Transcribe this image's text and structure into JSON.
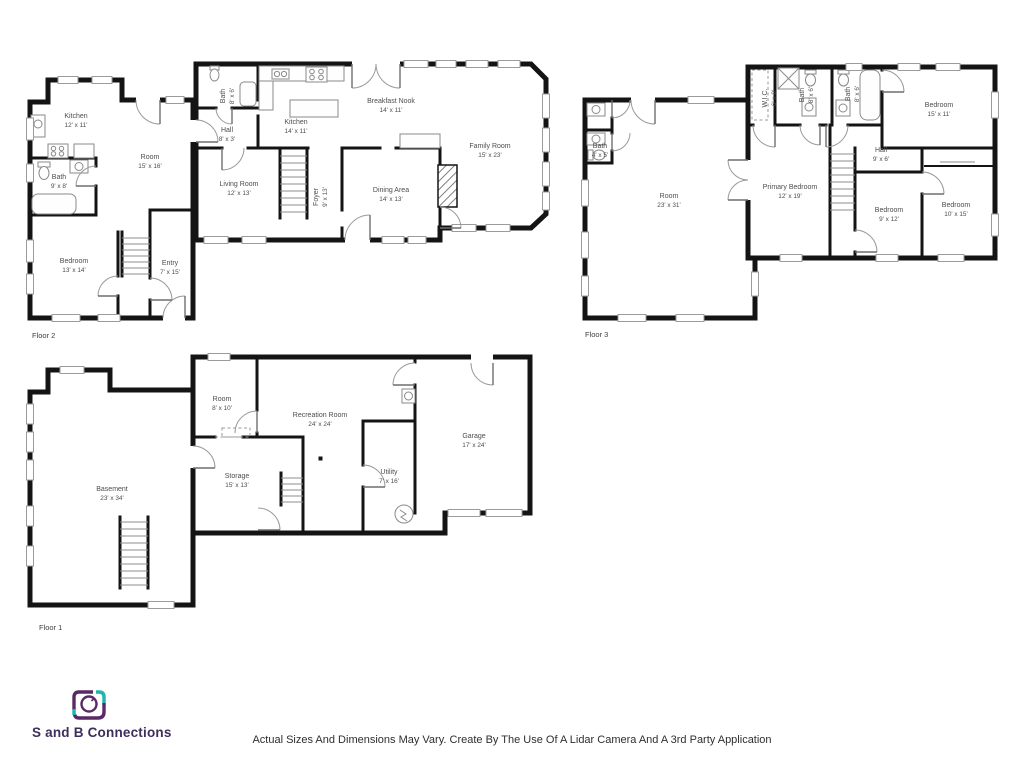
{
  "floors": [
    {
      "label": "Floor 2",
      "rooms": [
        {
          "name": "Kitchen",
          "dims": "12' x 11'"
        },
        {
          "name": "Room",
          "dims": "15' x 16'"
        },
        {
          "name": "Bath",
          "dims": "9' x 8'"
        },
        {
          "name": "Bedroom",
          "dims": "13' x 14'"
        },
        {
          "name": "Entry",
          "dims": "7' x 15'"
        },
        {
          "name": "Bath",
          "dims": "8' x 6'"
        },
        {
          "name": "Hall",
          "dims": "8' x 3'"
        },
        {
          "name": "Kitchen",
          "dims": "14' x 11'"
        },
        {
          "name": "Breakfast Nook",
          "dims": "14' x 11'"
        },
        {
          "name": "Living Room",
          "dims": "12' x 13'"
        },
        {
          "name": "Foyer",
          "dims": "9' x 13'"
        },
        {
          "name": "Dining Area",
          "dims": "14' x 13'"
        },
        {
          "name": "Family Room",
          "dims": "15' x 23'"
        }
      ]
    },
    {
      "label": "Floor 3",
      "rooms": [
        {
          "name": "Bath",
          "dims": "4' x 5'"
        },
        {
          "name": "Room",
          "dims": "23' x 31'"
        },
        {
          "name": "W.I.C.",
          "dims": "6' x 8'"
        },
        {
          "name": "Bath",
          "dims": "8' x 6'"
        },
        {
          "name": "Bath",
          "dims": "8' x 6'"
        },
        {
          "name": "Bedroom",
          "dims": "15' x 11'"
        },
        {
          "name": "Hall",
          "dims": "9' x 6'"
        },
        {
          "name": "Primary Bedroom",
          "dims": "12' x 19'"
        },
        {
          "name": "Bedroom",
          "dims": "9' x 12'"
        },
        {
          "name": "Bedroom",
          "dims": "10' x 15'"
        }
      ]
    },
    {
      "label": "Floor 1",
      "rooms": [
        {
          "name": "Basement",
          "dims": "23' x 34'"
        },
        {
          "name": "Room",
          "dims": "8' x 10'"
        },
        {
          "name": "Recreation Room",
          "dims": "24' x 24'"
        },
        {
          "name": "Storage",
          "dims": "15' x 13'"
        },
        {
          "name": "Utility",
          "dims": "7' x 16'"
        },
        {
          "name": "Garage",
          "dims": "17' x 24'"
        }
      ]
    }
  ],
  "footer": {
    "brand": "S and B Connections",
    "disclaimer": "Actual Sizes And Dimensions May Vary. Create By The Use Of A Lidar Camera And A 3rd Party Application"
  },
  "colors": {
    "wall": "#141414",
    "label_text": "#4d4d4d",
    "logo_purple": "#5a2a66",
    "logo_teal": "#1fb5ad",
    "brand_text": "#3f2d5c"
  }
}
